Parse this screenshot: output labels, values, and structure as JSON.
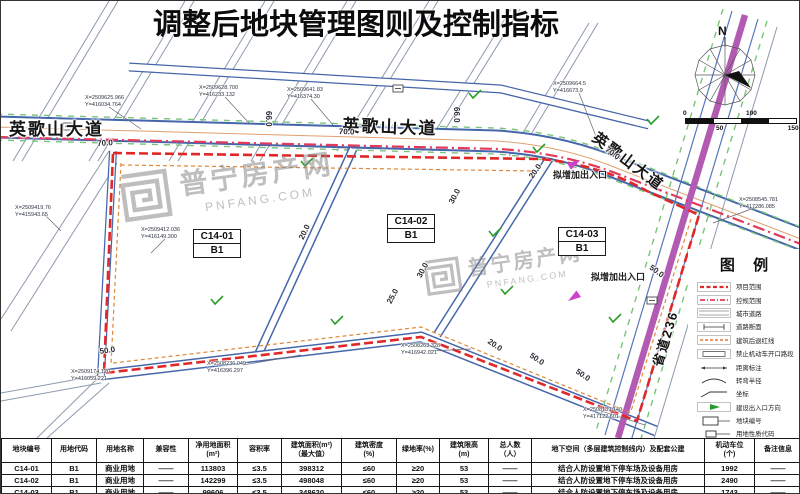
{
  "title": "调整后地块管理图则及控制指标",
  "compass": {
    "north_label": "N"
  },
  "scale_bar": {
    "ticks": [
      "0",
      "50",
      "100",
      "150M"
    ]
  },
  "watermark": {
    "name": "普宁房产网",
    "domain": "PNFANG.COM"
  },
  "map": {
    "road_labels": [
      {
        "text": "英歌山大道",
        "x": 8,
        "y": 114,
        "rotate": 0,
        "size": 17
      },
      {
        "text": "英歌山大道",
        "x": 342,
        "y": 110,
        "rotate": 2,
        "size": 17
      },
      {
        "text": "英歌山大道",
        "x": 600,
        "y": 126,
        "rotate": 37,
        "size": 15
      },
      {
        "text": "省道236",
        "x": 646,
        "y": 362,
        "rotate": -73,
        "size": 13
      }
    ],
    "plots": [
      {
        "code": "C14-01",
        "use_code": "B1",
        "x": 192,
        "y": 228
      },
      {
        "code": "C14-02",
        "use_code": "B1",
        "x": 386,
        "y": 213
      },
      {
        "code": "C14-03",
        "use_code": "B1",
        "x": 557,
        "y": 226
      }
    ],
    "entry_notes": [
      {
        "text": "拟增加出入口",
        "x": 552,
        "y": 167
      },
      {
        "text": "拟增加出入口",
        "x": 590,
        "y": 269
      }
    ],
    "dimensions": [
      {
        "text": "70.0",
        "x": 96,
        "y": 138,
        "rotate": -3
      },
      {
        "text": "70.0",
        "x": 338,
        "y": 126,
        "rotate": 2
      },
      {
        "text": "70.0",
        "x": 608,
        "y": 144,
        "rotate": 36
      },
      {
        "text": "66.0",
        "x": 272,
        "y": 110,
        "rotate": 90
      },
      {
        "text": "66.0",
        "x": 460,
        "y": 106,
        "rotate": 90
      },
      {
        "text": "50.0",
        "x": 98,
        "y": 346,
        "rotate": -8
      },
      {
        "text": "20.0",
        "x": 490,
        "y": 336,
        "rotate": 34
      },
      {
        "text": "50.0",
        "x": 532,
        "y": 350,
        "rotate": 34
      },
      {
        "text": "50.0",
        "x": 578,
        "y": 366,
        "rotate": 34
      },
      {
        "text": "25.0",
        "x": 384,
        "y": 300,
        "rotate": -62
      },
      {
        "text": "30.0",
        "x": 446,
        "y": 200,
        "rotate": -62
      },
      {
        "text": "30.0",
        "x": 414,
        "y": 274,
        "rotate": -62
      },
      {
        "text": "20.0",
        "x": 296,
        "y": 236,
        "rotate": -64
      },
      {
        "text": "20.0",
        "x": 526,
        "y": 174,
        "rotate": -55
      },
      {
        "text": "50.0",
        "x": 652,
        "y": 262,
        "rotate": 36
      }
    ],
    "coordinate_labels": [
      {
        "x": 84,
        "y": 94,
        "lines": [
          "X=2509625.966",
          "Y=416034.764"
        ]
      },
      {
        "x": 198,
        "y": 84,
        "lines": [
          "X=2509628.700",
          "Y=416233.132"
        ]
      },
      {
        "x": 286,
        "y": 86,
        "lines": [
          "X=2509641.83",
          "Y=416374.30"
        ]
      },
      {
        "x": 552,
        "y": 80,
        "lines": [
          "X=2509664.5",
          "Y=416673.9"
        ]
      },
      {
        "x": 738,
        "y": 196,
        "lines": [
          "X=2508545.781",
          "Y=417286.085"
        ]
      },
      {
        "x": 14,
        "y": 204,
        "lines": [
          "X=2509419.76",
          "Y=415943.65"
        ]
      },
      {
        "x": 140,
        "y": 226,
        "lines": [
          "X=2509412.036",
          "Y=416149.300"
        ]
      },
      {
        "x": 70,
        "y": 368,
        "lines": [
          "X=2509174.120",
          "Y=416059.221"
        ]
      },
      {
        "x": 206,
        "y": 360,
        "lines": [
          "X=2508236.049",
          "Y=416396.297"
        ]
      },
      {
        "x": 400,
        "y": 342,
        "lines": [
          "X=2508263.328",
          "Y=416942.021"
        ]
      },
      {
        "x": 582,
        "y": 406,
        "lines": [
          "X=2508139.140",
          "Y=417122.601"
        ]
      }
    ]
  },
  "legend": {
    "title": "图 例",
    "items": [
      {
        "label": "项目范围",
        "symbol": "project-boundary"
      },
      {
        "label": "控规范围",
        "symbol": "control-boundary"
      },
      {
        "label": "城市道路",
        "symbol": "city-road"
      },
      {
        "label": "道路断面",
        "symbol": "road-section"
      },
      {
        "label": "建筑后退红线",
        "symbol": "setback-line"
      },
      {
        "label": "禁止机动车开口路段",
        "symbol": "no-vehicle-opening"
      },
      {
        "label": "距离标注",
        "symbol": "distance-mark"
      },
      {
        "label": "转弯半径",
        "symbol": "turn-radius"
      },
      {
        "label": "坐标",
        "symbol": "coordinate-mark"
      },
      {
        "label": "建设出入口方向",
        "symbol": "entrance-direction"
      },
      {
        "label": "地块编号",
        "symbol": "plot-code"
      },
      {
        "label": "用地性质代码",
        "symbol": "use-code"
      }
    ]
  },
  "table": {
    "headers": [
      "地块编号",
      "用地代码",
      "用地名称",
      "兼容性",
      "净用地面积\n(m²)",
      "容积率",
      "建筑面积(m²)\n（最大值）",
      "建筑密度\n(%)",
      "绿地率(%)",
      "建筑限高\n(m)",
      "总人数\n（人）",
      "地下空间（多层建筑控制线内）及配套公建",
      "机动车位\n(个)",
      "备注信息"
    ],
    "rows": [
      [
        "C14-01",
        "B1",
        "商业用地",
        "——",
        "113803",
        "≤3.5",
        "398312",
        "≤60",
        "≥20",
        "53",
        "——",
        "结合人防设置地下停车场及设备用房",
        "1992",
        "——"
      ],
      [
        "C14-02",
        "B1",
        "商业用地",
        "——",
        "142299",
        "≤3.5",
        "498048",
        "≤60",
        "≥20",
        "53",
        "——",
        "结合人防设置地下停车场及设备用房",
        "2490",
        "——"
      ],
      [
        "C14-03",
        "B1",
        "商业用地",
        "——",
        "99606",
        "≤3.5",
        "348620",
        "≤60",
        "≥20",
        "53",
        "——",
        "结合人防设置地下停车场及设备用房",
        "1743",
        "——"
      ]
    ]
  }
}
